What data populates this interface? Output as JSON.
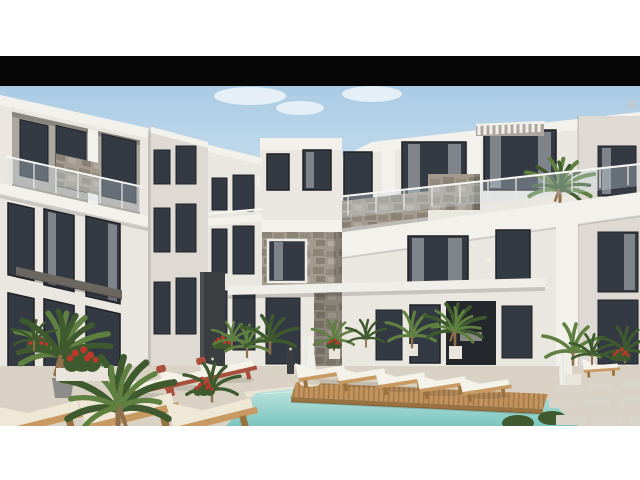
{
  "media": {
    "type": "architectural-rendering",
    "alt": "Rendering of a modern white resort apartment complex around a pool courtyard with wooden deck, sun loungers, fountains and palm plants"
  },
  "palette": {
    "page_bg": "#ffffff",
    "black_bar": "#060606",
    "sky_top": "#a9cbe4",
    "sky_bottom": "#dce9f3",
    "cloud": "#eef4f8",
    "wall_bright": "#f3f1ec",
    "wall_light": "#eae7e1",
    "wall_mid": "#dedad3",
    "wall_shadow": "#cbc7c0",
    "recess_dark": "#aba79f",
    "window_frame": "#1e2125",
    "window_glass": "#343a43",
    "curtain": "#c9ccd1",
    "stone_light": "#a39a8d",
    "stone_dark": "#6f665b",
    "slate": "#3a3e41",
    "slate_hi": "#5a5f62",
    "beam": "#f0eee9",
    "pool_light": "#bfe4de",
    "pool_deep": "#7cc6c0",
    "coping": "#ece5d6",
    "deck_wood": "#c2925f",
    "deck_gap": "#99723f",
    "lounger_wood": "#c89a62",
    "cushion_white": "#f5f2ea",
    "cushion_cream": "#efe8d7",
    "terracotta": "#a94f3d",
    "leaf_dark": "#3e5a2e",
    "leaf_mid": "#5f8040",
    "flower_red": "#c2372c",
    "pot_gray": "#8c8c8a",
    "pot_white": "#e9e5dc",
    "pavement": "#d9d2c4",
    "paver": "#d8d4ca"
  },
  "scene": {
    "elements": [
      "sky",
      "clouds",
      "left-apartment-building",
      "left-wing",
      "center-low-building",
      "center-tower",
      "right-apartment-building",
      "far-right-block",
      "stone-clad-balcony",
      "glass-balustrade",
      "pergola-slats",
      "balcony-palm",
      "concrete-beam",
      "slate-pillar",
      "swimming-pool",
      "wooden-pool-deck",
      "sun-loungers",
      "foreground-loungers",
      "water-fountains",
      "bollard-lights",
      "potted-palms",
      "red-flowering-plants",
      "stone-pavers",
      "terrace-pavement"
    ]
  }
}
